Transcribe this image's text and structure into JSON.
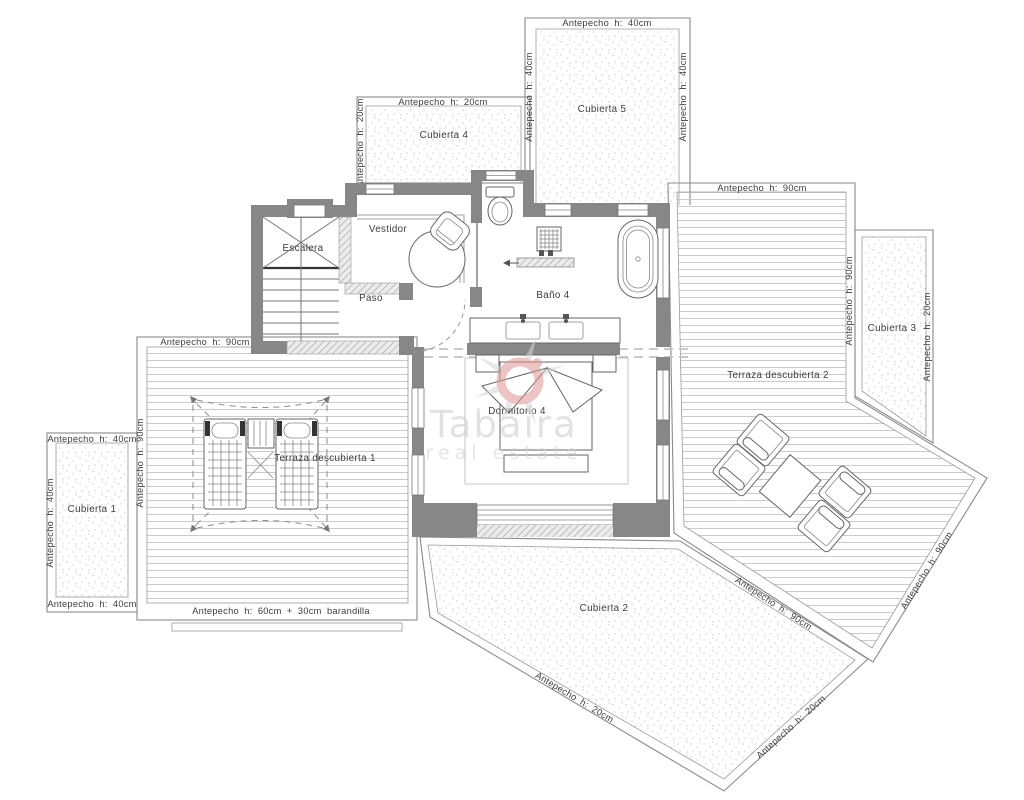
{
  "plan": {
    "watermark": {
      "line1": "Tabaira",
      "line2": "real estate"
    },
    "rooms": {
      "escalera": "Escalera",
      "vestidor": "Vestidor",
      "paso": "Paso",
      "bano4": "Baño 4",
      "dormitorio4": "Dormitorio 4",
      "terraza1": "Terraza descubierta 1",
      "terraza2": "Terraza descubierta 2",
      "cubierta1": "Cubierta 1",
      "cubierta2": "Cubierta 2",
      "cubierta3": "Cubierta 3",
      "cubierta4": "Cubierta 4",
      "cubierta5": "Cubierta 5"
    },
    "parapets": {
      "h20": "Antepecho h: 20cm",
      "h40": "Antepecho h: 40cm",
      "h90": "Antepecho h: 90cm",
      "h60_30": "Antepecho h: 60cm + 30cm barandilla"
    },
    "colors": {
      "wall_gray": "#878787",
      "watermark_pink": "#dd9494",
      "line_gray": "#8f8f8f",
      "deck_line": "#cbcbcb"
    }
  }
}
